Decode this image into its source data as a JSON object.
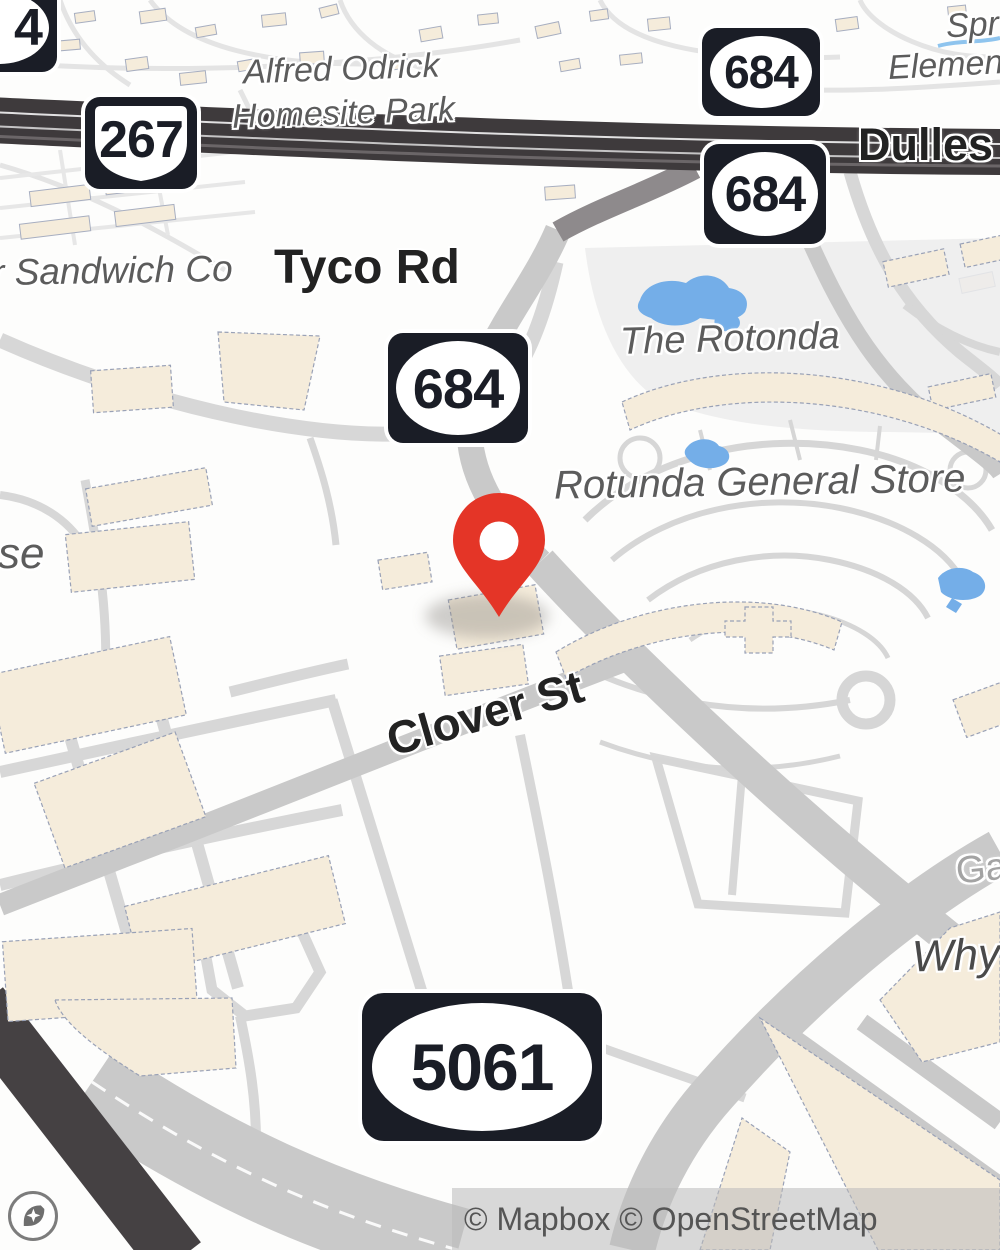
{
  "map": {
    "provider": "Mapbox",
    "colors": {
      "background": "#fdfdfc",
      "road_light": "#d7d7d7",
      "road_medium": "#c9c9c9",
      "road_dark": "#3e3a3c",
      "building": "#f5ecdb",
      "water": "#74aee8",
      "shield_dark": "#1a1d26",
      "marker_red": "#e43527",
      "place_label": "#5c5c5c",
      "road_label": "#222222"
    },
    "shields": {
      "partial4": "4",
      "s267": "267",
      "s684": "684",
      "s5061": "5061"
    },
    "labels": {
      "park_line1": "Alfred Odrick",
      "park_line2": "Homesite Park",
      "sandwich": "r Sandwich Co",
      "tyco": "Tyco Rd",
      "rotonda": "The Rotonda",
      "general_store": "Rotunda General Store",
      "clover": "Clover St",
      "dulles": "Dulles",
      "spr": "Spr",
      "elemen": "Elemen",
      "se": "se",
      "ga": "Ga",
      "why": "Why"
    },
    "marker": {
      "name": "dropped-pin"
    },
    "attribution": {
      "text": "© Mapbox © OpenStreetMap"
    }
  }
}
